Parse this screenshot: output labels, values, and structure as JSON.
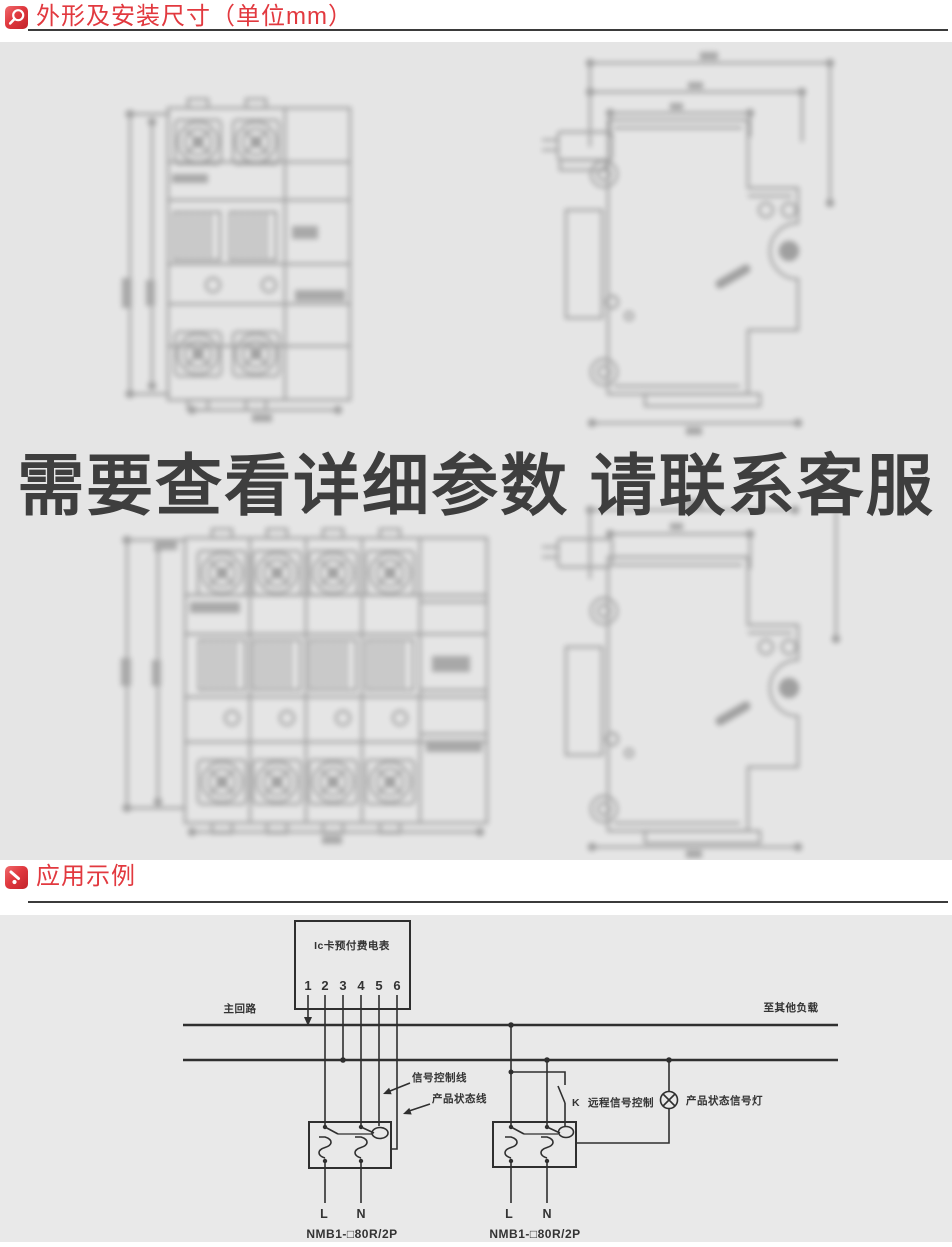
{
  "section1": {
    "title": "外形及安装尺寸（单位mm）",
    "icon": "magnifier-icon"
  },
  "overlay": {
    "text": "需要查看详细参数 请联系客服"
  },
  "section2": {
    "title": "应用示例",
    "icon": "pointer-icon"
  },
  "colors": {
    "accent_red": "#e2393f",
    "divider_dark": "#3b3b3b",
    "panel_gray_top": "#e5e5e5",
    "panel_gray_bottom": "#e9e9e9",
    "diagram_line": "#2f2f2f",
    "overlay_text": "#3e3e3e"
  },
  "diagram": {
    "meter_label": "Ic卡预付费电表",
    "terminals": [
      "1",
      "2",
      "3",
      "4",
      "5",
      "6"
    ],
    "main_circuit_label": "主回路",
    "other_loads_label": "至其他负载",
    "signal_control_label": "信号控制线",
    "product_status_label": "产品状态线",
    "k_switch_label": "K",
    "remote_signal_label": "远程信号控制",
    "status_lamp_label": "产品状态信号灯",
    "left_breaker": {
      "l": "L",
      "n": "N",
      "model": "NMB1-□80R/2P"
    },
    "right_breaker": {
      "l": "L",
      "n": "N",
      "model": "NMB1-□80R/2P"
    }
  }
}
